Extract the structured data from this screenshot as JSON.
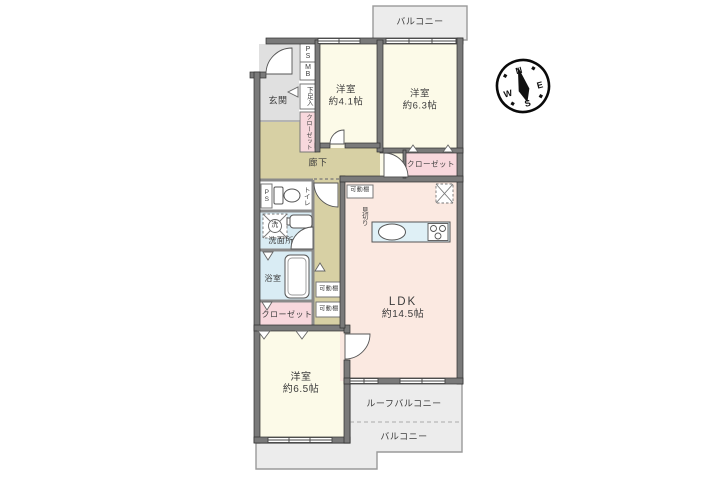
{
  "plan_type": "間取り図",
  "compass": {
    "n": "N",
    "e": "E",
    "s": "S",
    "w": "W"
  },
  "balconies": {
    "balcony": "バルコニー",
    "roof_balcony": "ルーフバルコニー"
  },
  "rooms": {
    "genkan": "玄関",
    "hallway": "廊下",
    "western_room_1": {
      "name": "洋室",
      "size": "約4.1帖"
    },
    "western_room_2": {
      "name": "洋室",
      "size": "約6.3帖"
    },
    "western_room_3": {
      "name": "洋室",
      "size": "約6.5帖"
    },
    "ldk": {
      "name": "LDK",
      "size": "約14.5帖"
    },
    "washroom": "洗面所",
    "bathroom": "浴室",
    "toilet": "トイレ",
    "closet": "クローゼット",
    "shoe_box": "下足入",
    "pipe_space": "PS",
    "meter_box": "MB",
    "washer": "洗",
    "movable_shelf": "可動棚",
    "mikiri": "見切り"
  },
  "colors": {
    "wall": "#7a7a7a",
    "room_cream": "#fcfae8",
    "hall_tan": "#d7d0a4",
    "ldk_peach": "#fbe9e1",
    "wet_blue": "#d9ecf4",
    "closet_pink": "#f8d8dd",
    "balcony_gray": "#ececec",
    "genkan_gray": "#e0e0e0"
  }
}
